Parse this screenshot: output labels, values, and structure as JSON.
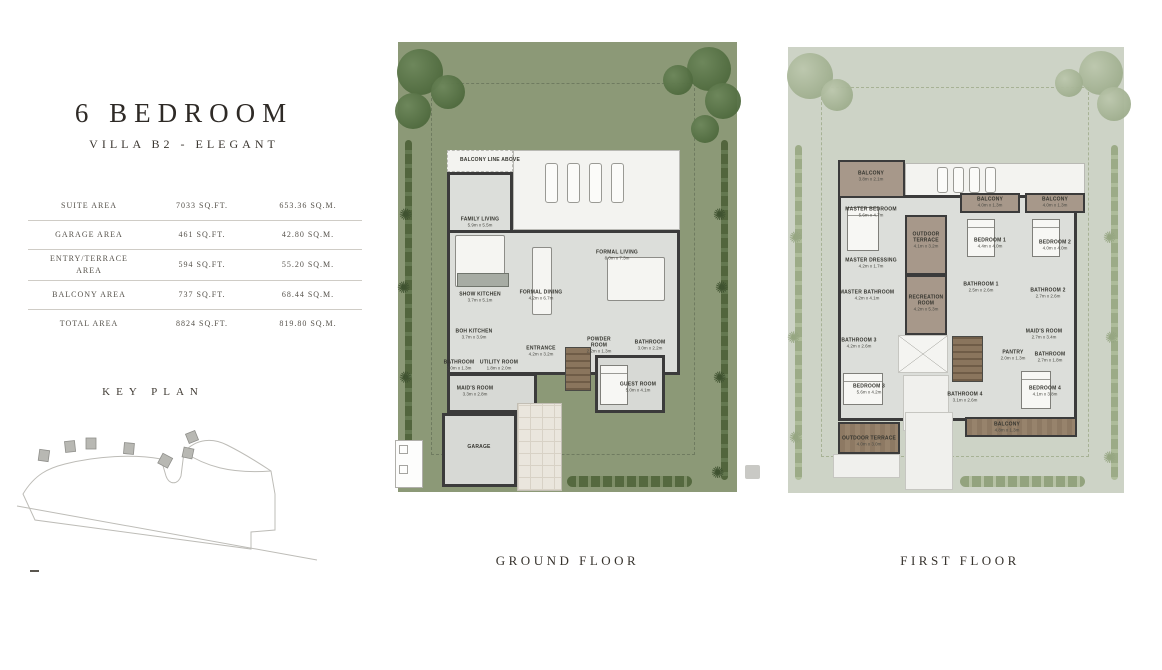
{
  "header": {
    "title": "6 BEDROOM",
    "subtitle": "VILLA B2 - ELEGANT"
  },
  "area_table": {
    "rows": [
      {
        "label": "SUITE AREA",
        "sqft": "7033 SQ.FT.",
        "sqm": "653.36 SQ.M."
      },
      {
        "label": "GARAGE AREA",
        "sqft": "461 SQ.FT.",
        "sqm": "42.80 SQ.M."
      },
      {
        "label": "ENTRY/TERRACE AREA",
        "sqft": "594 SQ.FT.",
        "sqm": "55.20 SQ.M."
      },
      {
        "label": "BALCONY AREA",
        "sqft": "737 SQ.FT.",
        "sqm": "68.44 SQ.M."
      },
      {
        "label": "TOTAL AREA",
        "sqft": "8824 SQ.FT.",
        "sqm": "819.80 SQ.M."
      }
    ]
  },
  "key_plan": {
    "title": "KEY PLAN"
  },
  "ground_floor": {
    "caption": "GROUND FLOOR",
    "note": "BALCONY LINE ABOVE",
    "rooms": [
      {
        "name": "FAMILY LIVING",
        "dims": "5.9m x 5.5m"
      },
      {
        "name": "SHOW KITCHEN",
        "dims": "3.7m x 5.1m"
      },
      {
        "name": "FORMAL DINING",
        "dims": "4.2m x 6.7m"
      },
      {
        "name": "FORMAL LIVING",
        "dims": "8.0m x 7.3m"
      },
      {
        "name": "BOH KITCHEN",
        "dims": "3.7m x 3.9m"
      },
      {
        "name": "BATHROOM",
        "dims": "2.0m x 1.3m"
      },
      {
        "name": "UTILITY ROOM",
        "dims": "1.8m x 2.0m"
      },
      {
        "name": "MAID'S ROOM",
        "dims": "3.3m x 2.8m"
      },
      {
        "name": "ENTRANCE",
        "dims": "4.2m x 3.2m"
      },
      {
        "name": "POWDER ROOM",
        "dims": "2.2m x 1.3m"
      },
      {
        "name": "BATHROOM",
        "dims": "3.0m x 2.2m"
      },
      {
        "name": "GUEST ROOM",
        "dims": "5.0m x 4.1m"
      },
      {
        "name": "GARAGE",
        "dims": ""
      }
    ]
  },
  "first_floor": {
    "caption": "FIRST FLOOR",
    "rooms": [
      {
        "name": "BALCONY",
        "dims": "3.8m x 2.1m"
      },
      {
        "name": "MASTER BEDROOM",
        "dims": "5.6m x 4.7m"
      },
      {
        "name": "MASTER DRESSING",
        "dims": "4.2m x 1.7m"
      },
      {
        "name": "MASTER BATHROOM",
        "dims": "4.2m x 4.1m"
      },
      {
        "name": "OUTDOOR TERRACE",
        "dims": "4.1m x 3.2m"
      },
      {
        "name": "RECREATION ROOM",
        "dims": "4.2m x 5.3m"
      },
      {
        "name": "BALCONY",
        "dims": "4.0m x 1.3m"
      },
      {
        "name": "BALCONY",
        "dims": "4.0m x 1.3m"
      },
      {
        "name": "BEDROOM 1",
        "dims": "4.4m x 4.0m"
      },
      {
        "name": "BEDROOM 2",
        "dims": "4.0m x 4.0m"
      },
      {
        "name": "BATHROOM 1",
        "dims": "2.5m x 2.6m"
      },
      {
        "name": "BATHROOM 2",
        "dims": "2.7m x 2.6m"
      },
      {
        "name": "BATHROOM 3",
        "dims": "4.2m x 2.6m"
      },
      {
        "name": "BEDROOM 3",
        "dims": "5.6m x 4.2m"
      },
      {
        "name": "BATHROOM 4",
        "dims": "3.1m x 2.6m"
      },
      {
        "name": "MAID'S ROOM",
        "dims": "2.7m x 3.4m"
      },
      {
        "name": "PANTRY",
        "dims": "2.0m x 1.3m"
      },
      {
        "name": "BATHROOM",
        "dims": "2.7m x 1.8m"
      },
      {
        "name": "BEDROOM 4",
        "dims": "4.1m x 3.8m"
      },
      {
        "name": "BALCONY",
        "dims": "4.8m x 1.3m"
      },
      {
        "name": "OUTDOOR TERRACE",
        "dims": "4.0m x 3.0m"
      }
    ]
  },
  "colors": {
    "lawn": "#8c9977",
    "lawn_faded": "#cdd3c6",
    "tree": "#5d7748",
    "tree_faded": "#b5c1a8",
    "wall": "#3b3b3b",
    "floor": "#dcdeda",
    "terrace_wood": "#a7988a",
    "deck": "#8d7963",
    "text": "#3f3a33",
    "rule": "#cfccc6"
  }
}
